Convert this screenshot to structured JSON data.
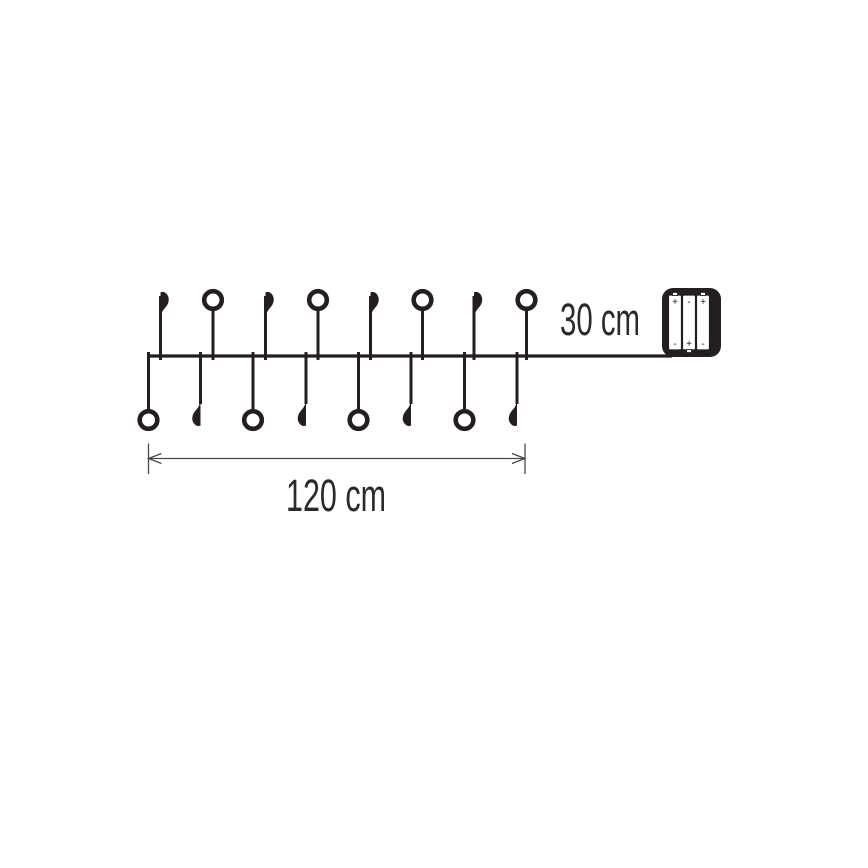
{
  "diagram": {
    "kind": "product-dimension-diagram",
    "subject": "battery-operated decorative string lights",
    "labels": {
      "total_length": "120 cm",
      "lead_length": "30 cm"
    },
    "colors": {
      "line": "#231f20",
      "dimension": "#4a4a4a",
      "text": "#2b2a29",
      "background": "#ffffff"
    },
    "string": {
      "led_count": 16,
      "wire_y": 356,
      "wire_x_start": 147,
      "wire_x_end": 672,
      "above_bulb_center_y": 300,
      "above_leaf_top_y": 294,
      "below_bulb_center_y": 420,
      "below_leaf_tip_y": 424,
      "bulb_radius": 8.8,
      "bulb_ring_width": 4.6,
      "stem_width": 3,
      "lights_above": [
        {
          "x": 160.5,
          "type": "leaf"
        },
        {
          "x": 213,
          "type": "bulb"
        },
        {
          "x": 265.5,
          "type": "leaf"
        },
        {
          "x": 318,
          "type": "bulb"
        },
        {
          "x": 370.5,
          "type": "leaf"
        },
        {
          "x": 422.5,
          "type": "bulb"
        },
        {
          "x": 474,
          "type": "leaf"
        },
        {
          "x": 526.5,
          "type": "bulb"
        }
      ],
      "lights_below": [
        {
          "x": 148.5,
          "type": "bulb"
        },
        {
          "x": 200.5,
          "type": "leaf"
        },
        {
          "x": 253,
          "type": "bulb"
        },
        {
          "x": 306,
          "type": "leaf"
        },
        {
          "x": 358.5,
          "type": "bulb"
        },
        {
          "x": 411,
          "type": "leaf"
        },
        {
          "x": 464.5,
          "type": "bulb"
        },
        {
          "x": 517,
          "type": "leaf"
        }
      ]
    },
    "dimension_total": {
      "x_start": 148.5,
      "x_end": 525,
      "line_y": 458.5,
      "tick_top_y": 443.5,
      "tick_bottom_y": 474,
      "arrow_length": 13,
      "arrow_half_height": 5
    },
    "lead_label_pos": {
      "x": 600,
      "y": 335
    },
    "total_label_pos": {
      "x": 336,
      "y": 511
    },
    "battery_box": {
      "x": 662,
      "y": 288,
      "width": 59,
      "height": 69,
      "corner_radius": 11,
      "cell_width": 13,
      "cell_gap": 1,
      "cell_inset_top": 7,
      "cell_inset_left": 6.5,
      "cells": [
        {
          "top": "+",
          "bottom": "-"
        },
        {
          "top": "-",
          "bottom": "+"
        },
        {
          "top": "+",
          "bottom": "-"
        }
      ]
    }
  }
}
